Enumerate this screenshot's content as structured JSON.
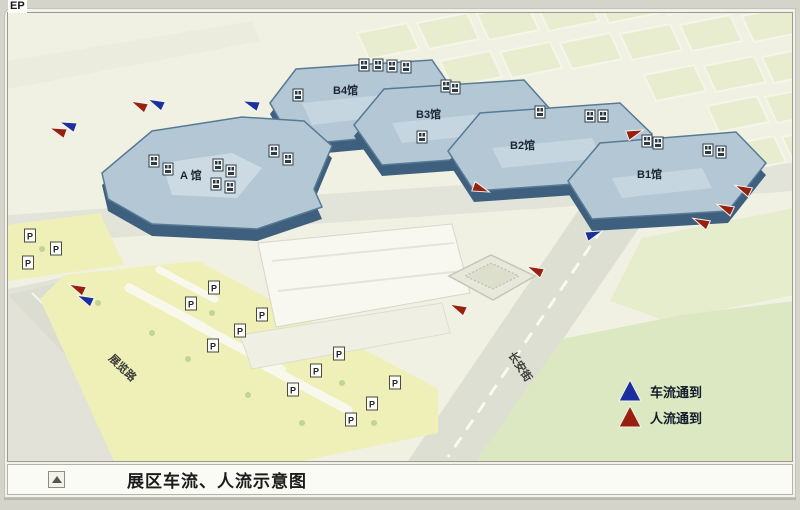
{
  "page": {
    "corner_text": "EP"
  },
  "caption": {
    "text": "展区车流、人流示意图"
  },
  "legend": {
    "items": [
      {
        "type": "vehicle",
        "label": "车流通到",
        "color": "#1c2f9e"
      },
      {
        "type": "people",
        "label": "人流通到",
        "color": "#97200f"
      }
    ]
  },
  "map": {
    "halls": [
      {
        "id": "a",
        "label": "A 馆"
      },
      {
        "id": "b4",
        "label": "B4馆"
      },
      {
        "id": "b3",
        "label": "B3馆"
      },
      {
        "id": "b2",
        "label": "B2馆"
      },
      {
        "id": "b1",
        "label": "B1馆"
      }
    ],
    "roads": [
      {
        "id": "zhanlan",
        "label": "展览路"
      },
      {
        "id": "changan",
        "label": "长安街"
      }
    ],
    "parking_symbol": "P",
    "parking_markers": [
      [
        28,
        233
      ],
      [
        54,
        246
      ],
      [
        26,
        260
      ],
      [
        212,
        285
      ],
      [
        189,
        301
      ],
      [
        260,
        312
      ],
      [
        238,
        328
      ],
      [
        211,
        343
      ],
      [
        337,
        351
      ],
      [
        314,
        368
      ],
      [
        291,
        387
      ],
      [
        393,
        380
      ],
      [
        370,
        401
      ],
      [
        349,
        417
      ]
    ],
    "roof_markers": [
      [
        152,
        158
      ],
      [
        166,
        166
      ],
      [
        216,
        162
      ],
      [
        229,
        168
      ],
      [
        272,
        148
      ],
      [
        286,
        156
      ],
      [
        214,
        181
      ],
      [
        228,
        184
      ],
      [
        362,
        62
      ],
      [
        376,
        62
      ],
      [
        390,
        63
      ],
      [
        404,
        64
      ],
      [
        296,
        92
      ],
      [
        444,
        83
      ],
      [
        453,
        85
      ],
      [
        420,
        134
      ],
      [
        538,
        109
      ],
      [
        588,
        113
      ],
      [
        601,
        113
      ],
      [
        645,
        138
      ],
      [
        656,
        140
      ],
      [
        706,
        147
      ],
      [
        719,
        149
      ]
    ],
    "flow_arrows": [
      {
        "type": "people",
        "x": 137,
        "y": 102,
        "angle": 205
      },
      {
        "type": "vehicle",
        "x": 154,
        "y": 100,
        "angle": 205
      },
      {
        "type": "vehicle",
        "x": 249,
        "y": 101,
        "angle": 200
      },
      {
        "type": "vehicle",
        "x": 66,
        "y": 122,
        "angle": 200
      },
      {
        "type": "people",
        "x": 56,
        "y": 128,
        "angle": 200
      },
      {
        "type": "people",
        "x": 75,
        "y": 285,
        "angle": 205
      },
      {
        "type": "vehicle",
        "x": 83,
        "y": 296,
        "angle": 205
      },
      {
        "type": "people",
        "x": 533,
        "y": 267,
        "angle": 205
      },
      {
        "type": "people",
        "x": 456,
        "y": 305,
        "angle": 205
      },
      {
        "type": "vehicle",
        "x": 592,
        "y": 231,
        "angle": 340
      },
      {
        "type": "people",
        "x": 633,
        "y": 130,
        "angle": 340
      },
      {
        "type": "people",
        "x": 479,
        "y": 186,
        "angle": 20
      },
      {
        "type": "people",
        "x": 741,
        "y": 186,
        "angle": 205
      },
      {
        "type": "people",
        "x": 723,
        "y": 205,
        "angle": 205
      },
      {
        "type": "people",
        "x": 699,
        "y": 219,
        "angle": 205
      }
    ]
  }
}
